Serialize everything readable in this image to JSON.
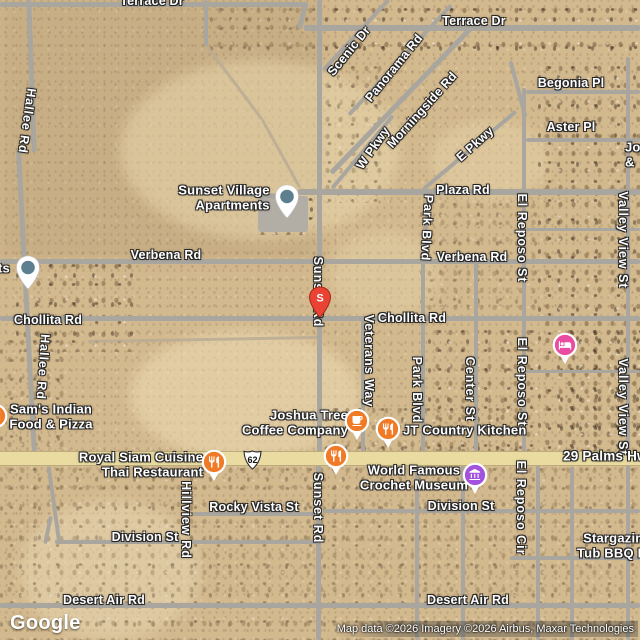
{
  "map": {
    "logo": "Google",
    "attribution": "Map data ©2026 Imagery ©2026 Airbus, Maxar Technologies",
    "shield_text": "62",
    "colors": {
      "desert": "#d3b98e",
      "road": "#a9a69f",
      "highway": "#eadca0",
      "red_pin": "#EA4335",
      "place_pin": "#5d7f90",
      "food_poi": "#F07A26",
      "museum_poi": "#A352DE",
      "lodging_poi": "#E94CA1"
    },
    "road_labels": [
      {
        "id": "terrace-dr-w",
        "text": "Terrace Dr",
        "x": 152,
        "y": 1
      },
      {
        "id": "terrace-dr-e",
        "text": "Terrace Dr",
        "x": 474,
        "y": 21
      },
      {
        "id": "scenic-dr",
        "text": "Scenic Dr",
        "x": 349,
        "y": 51,
        "rot": -51
      },
      {
        "id": "panorama-rd",
        "text": "Panorama Rd",
        "x": 394,
        "y": 68,
        "rot": -51
      },
      {
        "id": "morningside-rd",
        "text": "Morningside Rd",
        "x": 422,
        "y": 110,
        "rot": -48
      },
      {
        "id": "w-pkwy",
        "text": "W Pkwy",
        "x": 373,
        "y": 148,
        "rot": -55
      },
      {
        "id": "e-pkwy",
        "text": "E Pkwy",
        "x": 475,
        "y": 144,
        "rot": -42
      },
      {
        "id": "begonia-pl",
        "text": "Begonia Pl",
        "x": 571,
        "y": 83
      },
      {
        "id": "aster-pl",
        "text": "Aster Pl",
        "x": 571,
        "y": 127
      },
      {
        "id": "plaza-rd",
        "text": "Plaza Rd",
        "x": 463,
        "y": 190
      },
      {
        "id": "hallee-rd-n",
        "text": "Hallee Rd",
        "x": 27,
        "y": 121,
        "vertical": true,
        "rot": 8
      },
      {
        "id": "hallee-rd-s",
        "text": "Hallee Rd",
        "x": 43,
        "y": 367,
        "vertical": true,
        "rot": 4
      },
      {
        "id": "verbena-rd-w",
        "text": "Verbena Rd",
        "x": 166,
        "y": 255
      },
      {
        "id": "verbena-rd-e",
        "text": "Verbena Rd",
        "x": 472,
        "y": 257
      },
      {
        "id": "park-blvd-n",
        "text": "Park Blvd",
        "x": 427,
        "y": 228,
        "vertical": true,
        "rot": 3
      },
      {
        "id": "park-blvd-s",
        "text": "Park Blvd",
        "x": 417,
        "y": 390,
        "vertical": true
      },
      {
        "id": "el-reposo-st-n",
        "text": "El Reposo St",
        "x": 522,
        "y": 238,
        "vertical": true
      },
      {
        "id": "el-reposo-st-s",
        "text": "El Reposo St",
        "x": 522,
        "y": 382,
        "vertical": true
      },
      {
        "id": "valley-view-st-n",
        "text": "Valley View St",
        "x": 623,
        "y": 240,
        "vertical": true
      },
      {
        "id": "valley-view-st-s",
        "text": "Valley View St",
        "x": 623,
        "y": 407,
        "vertical": true
      },
      {
        "id": "chollita-rd-w",
        "text": "Chollita Rd",
        "x": 48,
        "y": 320
      },
      {
        "id": "chollita-rd-e",
        "text": "Chollita Rd",
        "x": 412,
        "y": 318
      },
      {
        "id": "veterans-way",
        "text": "Veterans Way",
        "x": 369,
        "y": 361,
        "vertical": true
      },
      {
        "id": "center-st",
        "text": "Center St",
        "x": 470,
        "y": 389,
        "vertical": true
      },
      {
        "id": "sunset-rd-n",
        "text": "Sunset Rd",
        "x": 318,
        "y": 292,
        "vertical": true
      },
      {
        "id": "sunset-rd-s",
        "text": "Sunset Rd",
        "x": 318,
        "y": 508,
        "vertical": true
      },
      {
        "id": "hillview-rd",
        "text": "Hillview Rd",
        "x": 186,
        "y": 520,
        "vertical": true
      },
      {
        "id": "el-reposo-cir",
        "text": "El Reposo Cir",
        "x": 521,
        "y": 508,
        "vertical": true
      },
      {
        "id": "rocky-vista-st",
        "text": "Rocky Vista St",
        "x": 254,
        "y": 507
      },
      {
        "id": "division-st-e",
        "text": "Division St",
        "x": 461,
        "y": 506
      },
      {
        "id": "division-st-w",
        "text": "Division St",
        "x": 145,
        "y": 537
      },
      {
        "id": "desert-air-rd-w",
        "text": "Desert Air Rd",
        "x": 104,
        "y": 600
      },
      {
        "id": "desert-air-rd-e",
        "text": "Desert Air Rd",
        "x": 468,
        "y": 600
      },
      {
        "id": "29-palms-hwy",
        "text": "29 Palms Hwy",
        "x": 563,
        "y": 456,
        "anchor": "left",
        "big": true
      }
    ],
    "poi_labels": [
      {
        "id": "sunset-village-apartments",
        "lines": [
          "Sunset Village",
          "Apartments"
        ],
        "x": 224,
        "y": 198,
        "align": "right"
      },
      {
        "id": "sams-indian-food-pizza",
        "lines": [
          "Sam's Indian",
          "Food & Pizza"
        ],
        "x": 51,
        "y": 417,
        "align": "center"
      },
      {
        "id": "joshua-tree-coffee-company",
        "lines": [
          "Joshua Tree",
          "Coffee Company"
        ],
        "x": 295,
        "y": 423,
        "align": "right"
      },
      {
        "id": "jt-country-kitchen",
        "lines": [
          "JT Country Kitchen"
        ],
        "x": 403,
        "y": 431,
        "align": "left",
        "anchor": "left"
      },
      {
        "id": "royal-siam-cuisine",
        "lines": [
          "Royal Siam Cuisine",
          "Thai Restaurant"
        ],
        "x": 141,
        "y": 465,
        "align": "right"
      },
      {
        "id": "world-famous-crochet-museum",
        "lines": [
          "World Famous",
          "Crochet Museum"
        ],
        "x": 414,
        "y": 478,
        "align": "center"
      },
      {
        "id": "stargazing-tub-bbq",
        "lines": [
          "Stargazin",
          "Tub BBQ Fi"
        ],
        "x": 577,
        "y": 546,
        "align": "center",
        "anchor": "left"
      },
      {
        "id": "cut-label-left-ts",
        "lines": [
          "ts"
        ],
        "x": -2,
        "y": 269,
        "align": "left",
        "anchor": "left"
      },
      {
        "id": "cut-label-right-jo",
        "lines": [
          "Jo",
          "&"
        ],
        "x": 625,
        "y": 155,
        "align": "left",
        "anchor": "left"
      }
    ],
    "markers": [
      {
        "id": "sunset-village-pin",
        "type": "pin-place",
        "x": 287,
        "y": 196
      },
      {
        "id": "left-edge-place-pin",
        "type": "pin-place",
        "x": 28,
        "y": 267
      },
      {
        "id": "s-marker",
        "type": "pin-letter",
        "letter": "S",
        "x": 320,
        "y": 297,
        "color": "#EA4335"
      },
      {
        "id": "lodging-pin",
        "type": "poi-lodging",
        "x": 565,
        "y": 345,
        "color": "#E94CA1"
      },
      {
        "id": "sams-restaurant-pin",
        "type": "poi-restaurant",
        "x": -5,
        "y": 416,
        "color": "#F07A26"
      },
      {
        "id": "coffee-pin",
        "type": "poi-coffee",
        "x": 357,
        "y": 421,
        "color": "#F07A26"
      },
      {
        "id": "jt-kitchen-restaurant-pin",
        "type": "poi-restaurant",
        "x": 388,
        "y": 429,
        "color": "#F07A26"
      },
      {
        "id": "highway-restaurant-pin",
        "type": "poi-restaurant",
        "x": 336,
        "y": 456,
        "color": "#F07A26"
      },
      {
        "id": "royal-siam-restaurant-pin",
        "type": "poi-restaurant",
        "x": 214,
        "y": 462,
        "color": "#F07A26"
      },
      {
        "id": "crochet-museum-pin",
        "type": "poi-museum",
        "x": 475,
        "y": 475,
        "color": "#A352DE"
      }
    ]
  }
}
